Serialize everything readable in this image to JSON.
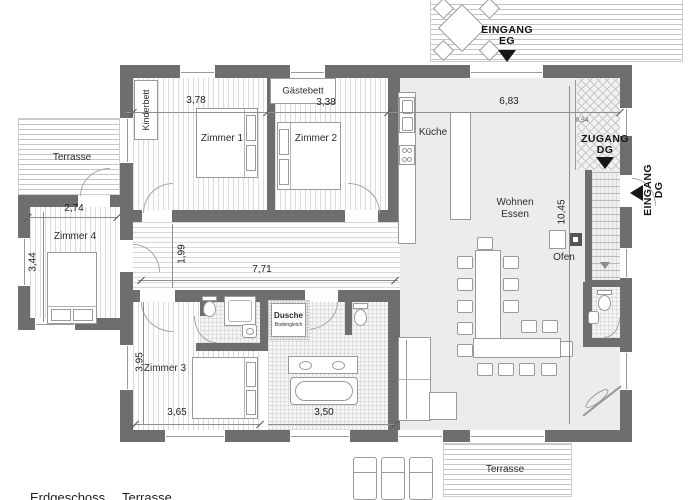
{
  "rooms": {
    "zimmer1": "Zimmer 1",
    "zimmer2": "Zimmer 2",
    "zimmer3": "Zimmer 3",
    "zimmer4": "Zimmer 4",
    "kueche": "Küche",
    "wohnen": "Wohnen",
    "essen": "Essen",
    "ofen": "Ofen",
    "dusche": "Dusche",
    "dusche_sub": "Bodengleich",
    "terrasse_left": "Terrasse",
    "terrasse_bottom": "Terrasse",
    "kinderbett": "Kinderbett",
    "gaestebett": "Gästebett"
  },
  "entrances": {
    "eingang_eg_line1": "EINGANG",
    "eingang_eg_line2": "EG",
    "zugang_dg_line1": "ZUGANG",
    "zugang_dg_line2": "DG",
    "eingang_dg_line1": "EINGANG",
    "eingang_dg_line2": "DG"
  },
  "dimensions": {
    "zimmer1_width": "3,78",
    "zimmer2_width": "3,38",
    "wohnbereich_width": "6,83",
    "zimmer4_width": "2,74",
    "zimmer4_depth": "3,44",
    "flur_width": "1,99",
    "flur_length": "7,71",
    "wohnbereich_depth": "10,45",
    "zimmer3_depth": "3,95",
    "zimmer3_width": "3,65",
    "bad_width": "3,50",
    "zugang_width": "0,54"
  },
  "legend": {
    "left": "Erdgeschoss",
    "right": "Terrasse"
  },
  "colors": {
    "wall": "#6e6e6e",
    "arrow": "#161616",
    "living_floor": "#ececec"
  }
}
